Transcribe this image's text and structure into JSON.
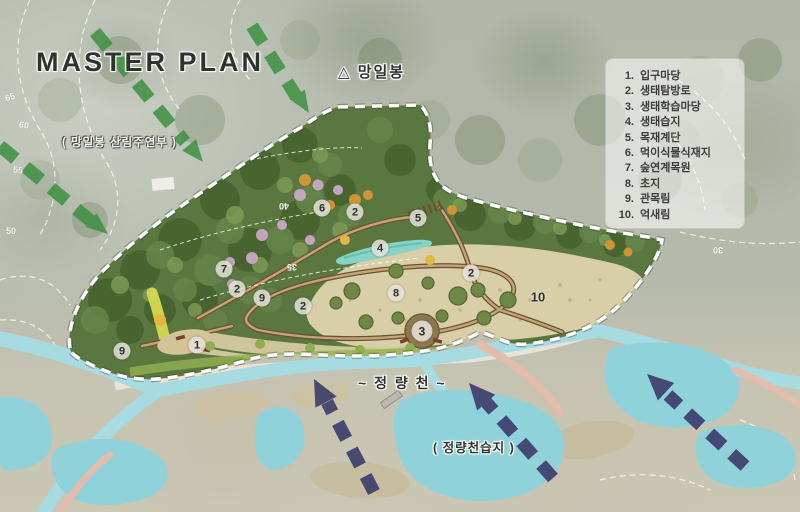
{
  "title": "MASTER PLAN",
  "labels": {
    "peak": "△ 망일봉",
    "forest_edge": "( 망일봉 산림주연부 )",
    "stream": "~ 정 량 천 ~",
    "wetland": "( 정량천습지 )"
  },
  "legend": {
    "items": [
      {
        "no": "1.",
        "label": "입구마당"
      },
      {
        "no": "2.",
        "label": "생태탐방로"
      },
      {
        "no": "3.",
        "label": "생태학습마당"
      },
      {
        "no": "4.",
        "label": "생태습지"
      },
      {
        "no": "5.",
        "label": "목재계단"
      },
      {
        "no": "6.",
        "label": "먹이식물식재지"
      },
      {
        "no": "7.",
        "label": "숲연계목원"
      },
      {
        "no": "8.",
        "label": "초지"
      },
      {
        "no": "9.",
        "label": "관목림"
      },
      {
        "no": "10.",
        "label": "억새림"
      }
    ]
  },
  "markers": [
    {
      "no": "1",
      "x": 197,
      "y": 345
    },
    {
      "no": "2",
      "x": 237,
      "y": 289
    },
    {
      "no": "2",
      "x": 303,
      "y": 306
    },
    {
      "no": "2",
      "x": 355,
      "y": 212
    },
    {
      "no": "2",
      "x": 471,
      "y": 273
    },
    {
      "no": "3",
      "x": 422,
      "y": 331,
      "big": true
    },
    {
      "no": "4",
      "x": 380,
      "y": 248
    },
    {
      "no": "5",
      "x": 418,
      "y": 218
    },
    {
      "no": "6",
      "x": 322,
      "y": 208
    },
    {
      "no": "7",
      "x": 224,
      "y": 269
    },
    {
      "no": "8",
      "x": 396,
      "y": 293
    },
    {
      "no": "9",
      "x": 262,
      "y": 298
    },
    {
      "no": "9",
      "x": 122,
      "y": 351
    },
    {
      "no": "10",
      "x": 538,
      "y": 297,
      "plain": true
    }
  ],
  "contour_labels": [
    {
      "text": "65",
      "x": 5,
      "y": 92,
      "rot": -15
    },
    {
      "text": "60",
      "x": 19,
      "y": 120,
      "rot": 10
    },
    {
      "text": "55",
      "x": 13,
      "y": 165,
      "rot": 8
    },
    {
      "text": "50",
      "x": 6,
      "y": 226,
      "rot": 0
    },
    {
      "text": "40",
      "x": 279,
      "y": 201,
      "rot": 180
    },
    {
      "text": "35",
      "x": 287,
      "y": 262,
      "rot": 180
    },
    {
      "text": "30",
      "x": 713,
      "y": 245,
      "rot": 180
    }
  ],
  "colors": {
    "forest_dark": "#46632f",
    "forest_base": "#5a7740",
    "forest_mid": "#66854a",
    "forest_light": "#7f9c55",
    "autumn_orange": "#cf9434",
    "blossom_pink": "#c9a8c6",
    "meadow_tan": "#d8cfa8",
    "meadow_tan2": "#cfc59c",
    "trail_brown": "#6e5234",
    "trail_fill": "#c2a678",
    "yard_brown": "#8d7850",
    "wetland_teal": "#86d4c6",
    "stream_cyan": "#a6dbe2",
    "pond_cyan": "#8fd2da",
    "path_pink": "#e3bcab",
    "promenade_white": "#eceadf",
    "arrow_green": "#3e9141",
    "arrow_navy": "#3c3c6b",
    "boundary_white": "#ffffff",
    "yellow_band": "#d6d84e",
    "bottom_green": "#93b050"
  }
}
